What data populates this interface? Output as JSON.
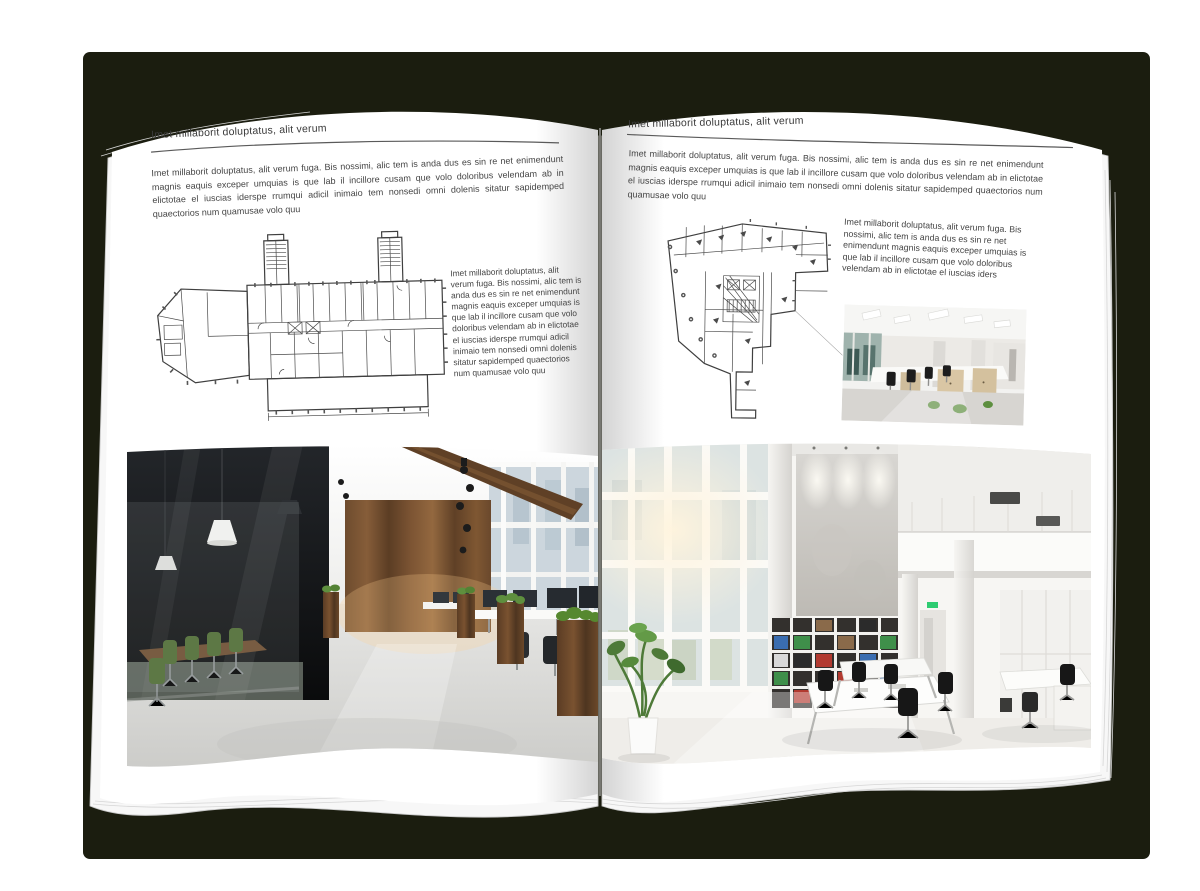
{
  "document": {
    "type": "interior-design brochure spread (open magazine mockup)",
    "backdrop_color": "#1b1d0f",
    "page_color": "#ffffff",
    "text_color": "#454545",
    "rule_color": "#5a5a5a"
  },
  "left_page": {
    "header": "Imet millaborit doluptatus, alit verum",
    "intro": "Imet millaborit doluptatus, alit verum fuga. Bis nossimi, alic tem is anda dus es sin re net enimendunt magnis eaquis exceper umquias is que lab il incillore cusam que volo doloribus velendam ab in elictotae el iuscias iderspe rrumqui adicil inimaio tem nonsedi omni dolenis sitatur sapidemped quaectorios num quamusae volo quu",
    "side_text": "Imet millaborit doluptatus, alit verum fuga. Bis nossimi, alic tem is anda dus es sin re net enimendunt magnis eaquis exceper umquias is que lab il incillore cusam que volo doloribus velendam ab in elictotae el iuscias iderspe rrumqui adicil inimaio tem nonsedi omni dolenis sitatur sapidemped quaectorios num quamusae volo quu",
    "figures": {
      "floorplan_alt": "architectural floor plan - long office block with two stair towers and angled west wing",
      "photo_alt": "open-plan office with dark glass meeting room, wood wall panels, green chairs and planters"
    }
  },
  "right_page": {
    "header": "Imet millaborit doluptatus, alit verum",
    "intro": "Imet millaborit doluptatus, alit verum fuga. Bis nossimi, alic tem is anda dus es sin re net enimendunt magnis eaquis exceper umquias is que lab il incillore cusam que volo doloribus velendam ab in elictotae el iuscias iderspe rrumqui adicil inimaio tem nonsedi omni dolenis sitatur sapidemped quaectorios num quamusae volo quu",
    "side_text": "Imet millaborit doluptatus, alit verum fuga. Bis nossimi, alic tem is anda dus es sin re net enimendunt magnis eaquis exceper umquias is que lab il incillore cusam que volo doloribus velendam ab in elictotae el iuscias iders",
    "figures": {
      "floorplan_alt": "architectural floor plan - irregular tower footprint with central core",
      "photo_small_alt": "modern office with rows of white desks, black chairs and light wood cabinets",
      "photo_alt": "bright double-height office atrium with glazed wall, concrete feature wall and binder shelves"
    }
  }
}
